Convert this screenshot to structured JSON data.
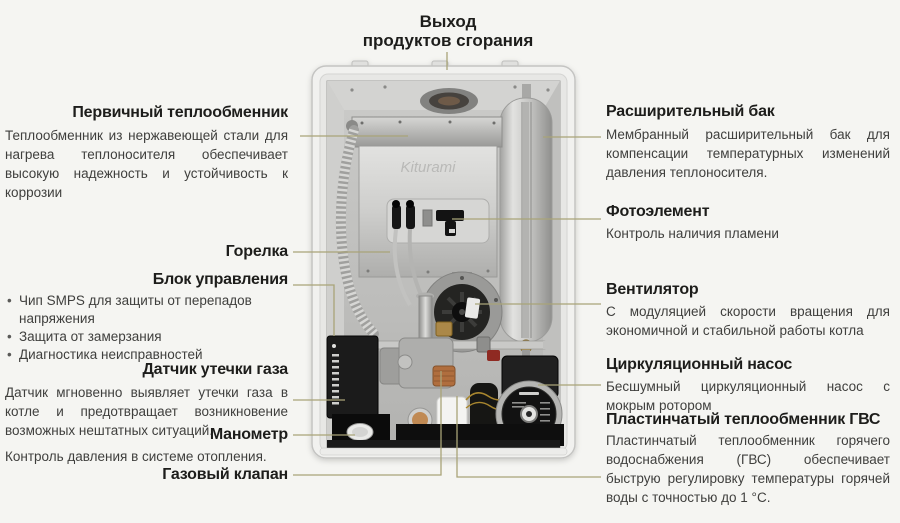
{
  "top_label": {
    "line1": "Выход",
    "line2": "продуктов сгорания"
  },
  "left_labels": [
    {
      "title": "Первичный теплообменник",
      "description": "Теплообменник из нержавеющей стали для нагрева теплоносителя обеспечивает высокую надежность и устойчивость к коррозии"
    },
    {
      "title": "Горелка"
    },
    {
      "title": "Блок управления",
      "bullets": [
        "Чип SMPS для защиты от перепадов напряжения",
        "Защита от замерзания",
        "Диагностика неисправностей"
      ]
    },
    {
      "title": "Датчик утечки газа",
      "description": "Датчик мгновенно выявляет утечки газа в котле и предотвращает возникновение возможных нештатных ситуаций."
    },
    {
      "title": "Манометр",
      "description": "Контроль давления в системе отопления."
    },
    {
      "title": "Газовый клапан"
    }
  ],
  "right_labels": [
    {
      "title": "Расширительный бак",
      "description": "Мембранный расширительный бак для компенсации температурных изменений давления теплоносителя."
    },
    {
      "title": "Фотоэлемент",
      "description": "Контроль наличия пламени"
    },
    {
      "title": "Вентилятор",
      "description": "С модуляцией скорости вращения для экономичной и стабильной работы котла"
    },
    {
      "title": "Циркуляционный насос",
      "description": "Бесшумный циркуляционный насос с мокрым ротором"
    },
    {
      "title": "Пластинчатый теплообменник ГВС",
      "description": "Пластинчатый теплообменник горячего водоснабжения (ГВС) обеспечивает быструю регулировку температуры горячей воды с точностью до 1 °С."
    }
  ],
  "boiler": {
    "brand": "Kiturami"
  },
  "colors": {
    "background": "#f5f5f2",
    "heading_text": "#1d1d1b",
    "body_text": "#3f3f3d",
    "leader_line": "#a9a478"
  }
}
